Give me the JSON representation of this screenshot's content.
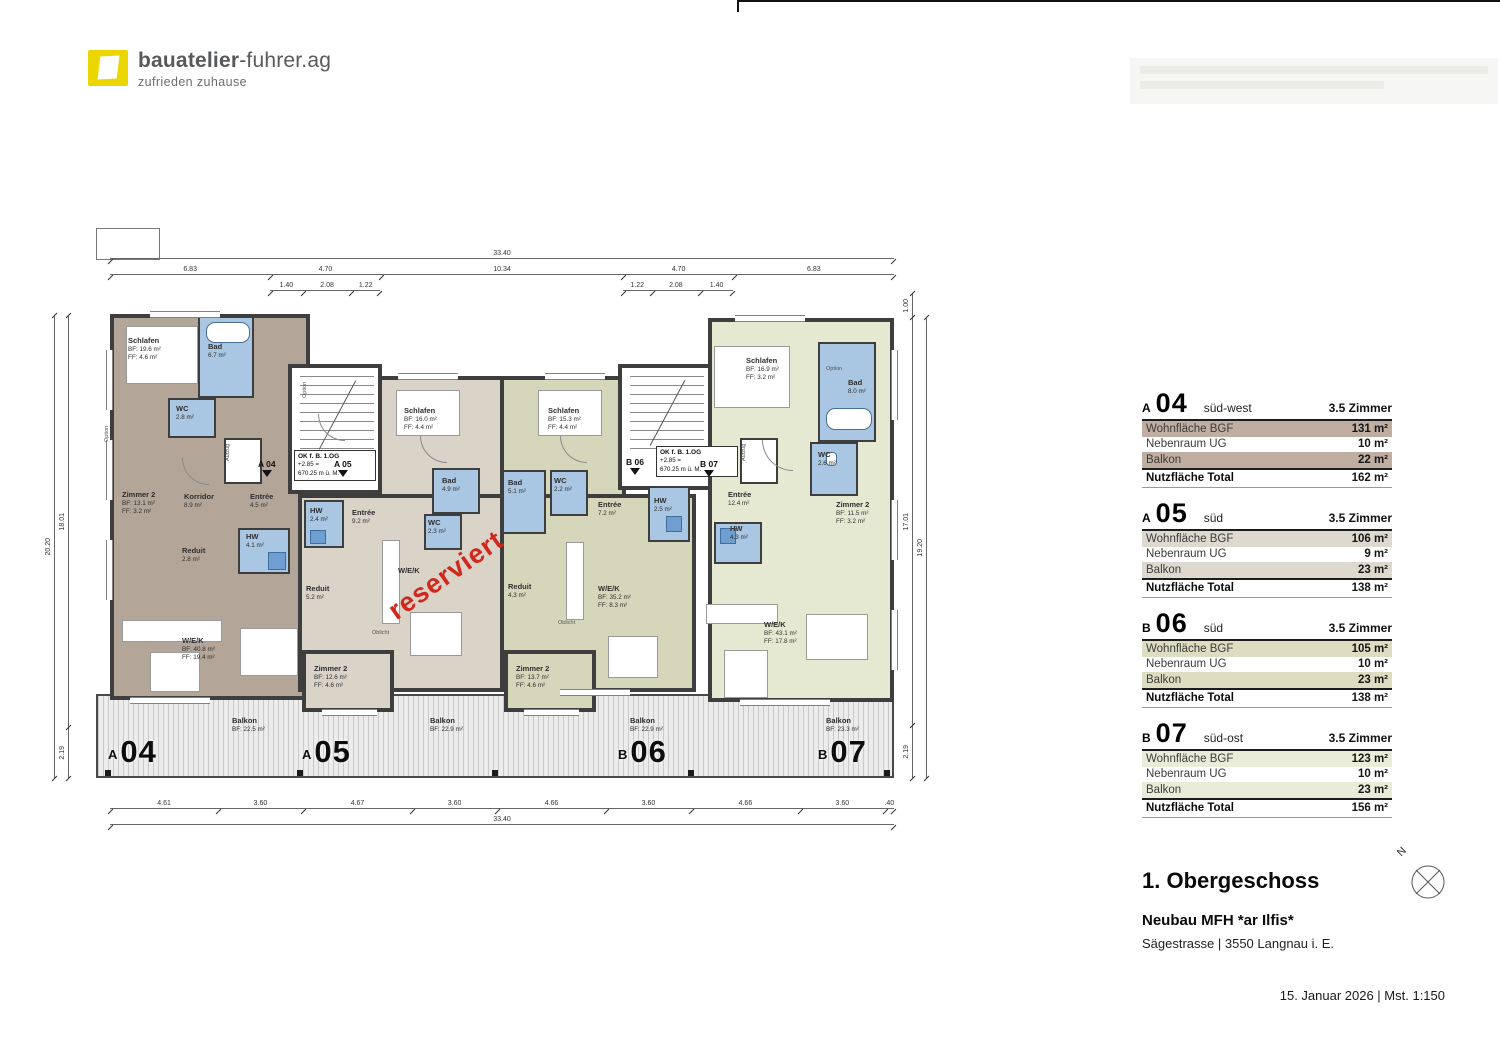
{
  "logo": {
    "brand_bold": "bauatelier",
    "brand_light": "-fuhrer.ag",
    "tagline": "zufrieden zuhause",
    "brand_color": "#ecd600",
    "text_color": "#58595b"
  },
  "tables": [
    {
      "prefix": "A",
      "num": "04",
      "orientation": "süd-west",
      "zimmer": "3.5 Zimmer",
      "accent": "#bfaea1",
      "rows": [
        [
          "Wohnfläche BGF",
          "131 m²"
        ],
        [
          "Nebenraum UG",
          "10 m²"
        ],
        [
          "Balkon",
          "22 m²"
        ],
        [
          "Nutzfläche Total",
          "162 m²"
        ]
      ]
    },
    {
      "prefix": "A",
      "num": "05",
      "orientation": "süd",
      "zimmer": "3.5 Zimmer",
      "accent": "#ded9ce",
      "rows": [
        [
          "Wohnfläche BGF",
          "106 m²"
        ],
        [
          "Nebenraum UG",
          "9 m²"
        ],
        [
          "Balkon",
          "23 m²"
        ],
        [
          "Nutzfläche Total",
          "138 m²"
        ]
      ]
    },
    {
      "prefix": "B",
      "num": "06",
      "orientation": "süd",
      "zimmer": "3.5 Zimmer",
      "accent": "#dcddc1",
      "rows": [
        [
          "Wohnfläche BGF",
          "105 m²"
        ],
        [
          "Nebenraum UG",
          "10 m²"
        ],
        [
          "Balkon",
          "23 m²"
        ],
        [
          "Nutzfläche Total",
          "138 m²"
        ]
      ]
    },
    {
      "prefix": "B",
      "num": "07",
      "orientation": "süd-ost",
      "zimmer": "3.5 Zimmer",
      "accent": "#e9ecd9",
      "rows": [
        [
          "Wohnfläche BGF",
          "123 m²"
        ],
        [
          "Nebenraum UG",
          "10 m²"
        ],
        [
          "Balkon",
          "23 m²"
        ],
        [
          "Nutzfläche Total",
          "156 m²"
        ]
      ]
    }
  ],
  "title_block": {
    "floor": "1. Obergeschoss",
    "project": "Neubau MFH *ar Ilfis*",
    "address": "Sägestrasse | 3550 Langnau i. E.",
    "date_scale": "15. Januar 2026  |  Mst. 1:150",
    "north_label": "N"
  },
  "plan": {
    "stamp": "reserviert",
    "stair_label": [
      "OK f. B. 1.OG",
      "+2.85 =",
      "670.25 m ü. M."
    ],
    "markers": {
      "a04": "A 04",
      "a05": "A 05",
      "b06": "B 06",
      "b07": "B 07"
    },
    "elevator": "Aufzug",
    "option": "Option",
    "oblicht": "Oblicht",
    "units": {
      "a04": {
        "prefix": "A",
        "num": "04",
        "color": "#b3a699",
        "rooms": {
          "schlafen": [
            "Schlafen",
            "BF: 19.6 m²",
            "FF:  4.6 m²"
          ],
          "bad": [
            "Bad",
            "6.7 m²"
          ],
          "wc": [
            "WC",
            "2.8 m²"
          ],
          "zimmer2": [
            "Zimmer 2",
            "BF: 13.1 m²",
            "FF:  3.2 m²"
          ],
          "korridor": [
            "Korridor",
            "8.9 m²"
          ],
          "entree": [
            "Entrée",
            "4.5 m²"
          ],
          "reduit": [
            "Reduit",
            "2.8 m²"
          ],
          "hw": [
            "HW",
            "4.1 m²"
          ],
          "wek": [
            "W/E/K",
            "BF: 40.8 m²",
            "FF: 19.4 m²"
          ],
          "balkon": [
            "Balkon",
            "BF: 22.5 m²"
          ]
        }
      },
      "a05": {
        "prefix": "A",
        "num": "05",
        "color": "#d9d3c8",
        "rooms": {
          "schlafen": [
            "Schlafen",
            "BF: 16.0 m²",
            "FF:  4.4 m²"
          ],
          "bad": [
            "Bad",
            "4.9 m²"
          ],
          "wc": [
            "WC",
            "2.3 m²"
          ],
          "hw": [
            "HW",
            "2.4 m²"
          ],
          "entree": [
            "Entrée",
            "9.2 m²"
          ],
          "reduit": [
            "Reduit",
            "5.2 m²"
          ],
          "wek": [
            "W/E/K"
          ],
          "zimmer2": [
            "Zimmer 2",
            "BF: 12.6 m²",
            "FF:  4.6 m²"
          ],
          "balkon": [
            "Balkon",
            "BF: 22.9 m²"
          ]
        }
      },
      "b06": {
        "prefix": "B",
        "num": "06",
        "color": "#d6d7ba",
        "rooms": {
          "schlafen": [
            "Schlafen",
            "BF: 15.3 m²",
            "FF:  4.4 m²"
          ],
          "bad": [
            "Bad",
            "5.1 m²"
          ],
          "wc": [
            "WC",
            "2.2 m²"
          ],
          "hw": [
            "HW",
            "2.5 m²"
          ],
          "entree": [
            "Entrée",
            "7.2 m²"
          ],
          "reduit": [
            "Reduit",
            "4.3 m²"
          ],
          "wek": [
            "W/E/K",
            "BF: 35.2 m²",
            "FF:  8.3 m²"
          ],
          "zimmer2": [
            "Zimmer 2",
            "BF: 13.7 m²",
            "FF:  4.6 m²"
          ],
          "balkon": [
            "Balkon",
            "BF: 22.9 m²"
          ]
        }
      },
      "b07": {
        "prefix": "B",
        "num": "07",
        "color": "#e6e9d2",
        "rooms": {
          "schlafen": [
            "Schlafen",
            "BF: 16.9 m²",
            "FF:  3.2 m²"
          ],
          "bad": [
            "Bad",
            "8.0 m²"
          ],
          "wc": [
            "WC",
            "2.6 m²"
          ],
          "entree": [
            "Entrée",
            "12.4 m²"
          ],
          "zimmer2": [
            "Zimmer 2",
            "BF: 11.5 m²",
            "FF:  3.2 m²"
          ],
          "hw": [
            "HW",
            "4.3 m²"
          ],
          "wek": [
            "W/E/K",
            "BF: 43.1 m²",
            "FF: 17.8 m²"
          ],
          "balkon": [
            "Balkon",
            "BF: 23.3 m²"
          ]
        }
      }
    },
    "dims": {
      "top_total": [
        "33.40"
      ],
      "top_main": [
        "6.83",
        "4.70",
        "10.34",
        "4.70",
        "6.83"
      ],
      "top_sub_left": [
        "1.40",
        "2.08",
        "1.22"
      ],
      "top_sub_right": [
        "1.22",
        "2.08",
        "1.40"
      ],
      "bottom_main": [
        "4.61",
        "3.60",
        "4.67",
        "3.60",
        "4.66",
        "3.60",
        "4.66",
        "3.60",
        ".40"
      ],
      "bottom_total": [
        "33.40"
      ],
      "left_outer": [
        "20.20"
      ],
      "left_inner": [
        "18.01",
        "2.19"
      ],
      "right_inner": [
        "1.00",
        "17.01",
        "2.19"
      ],
      "right_outer": [
        "19.20"
      ]
    }
  }
}
